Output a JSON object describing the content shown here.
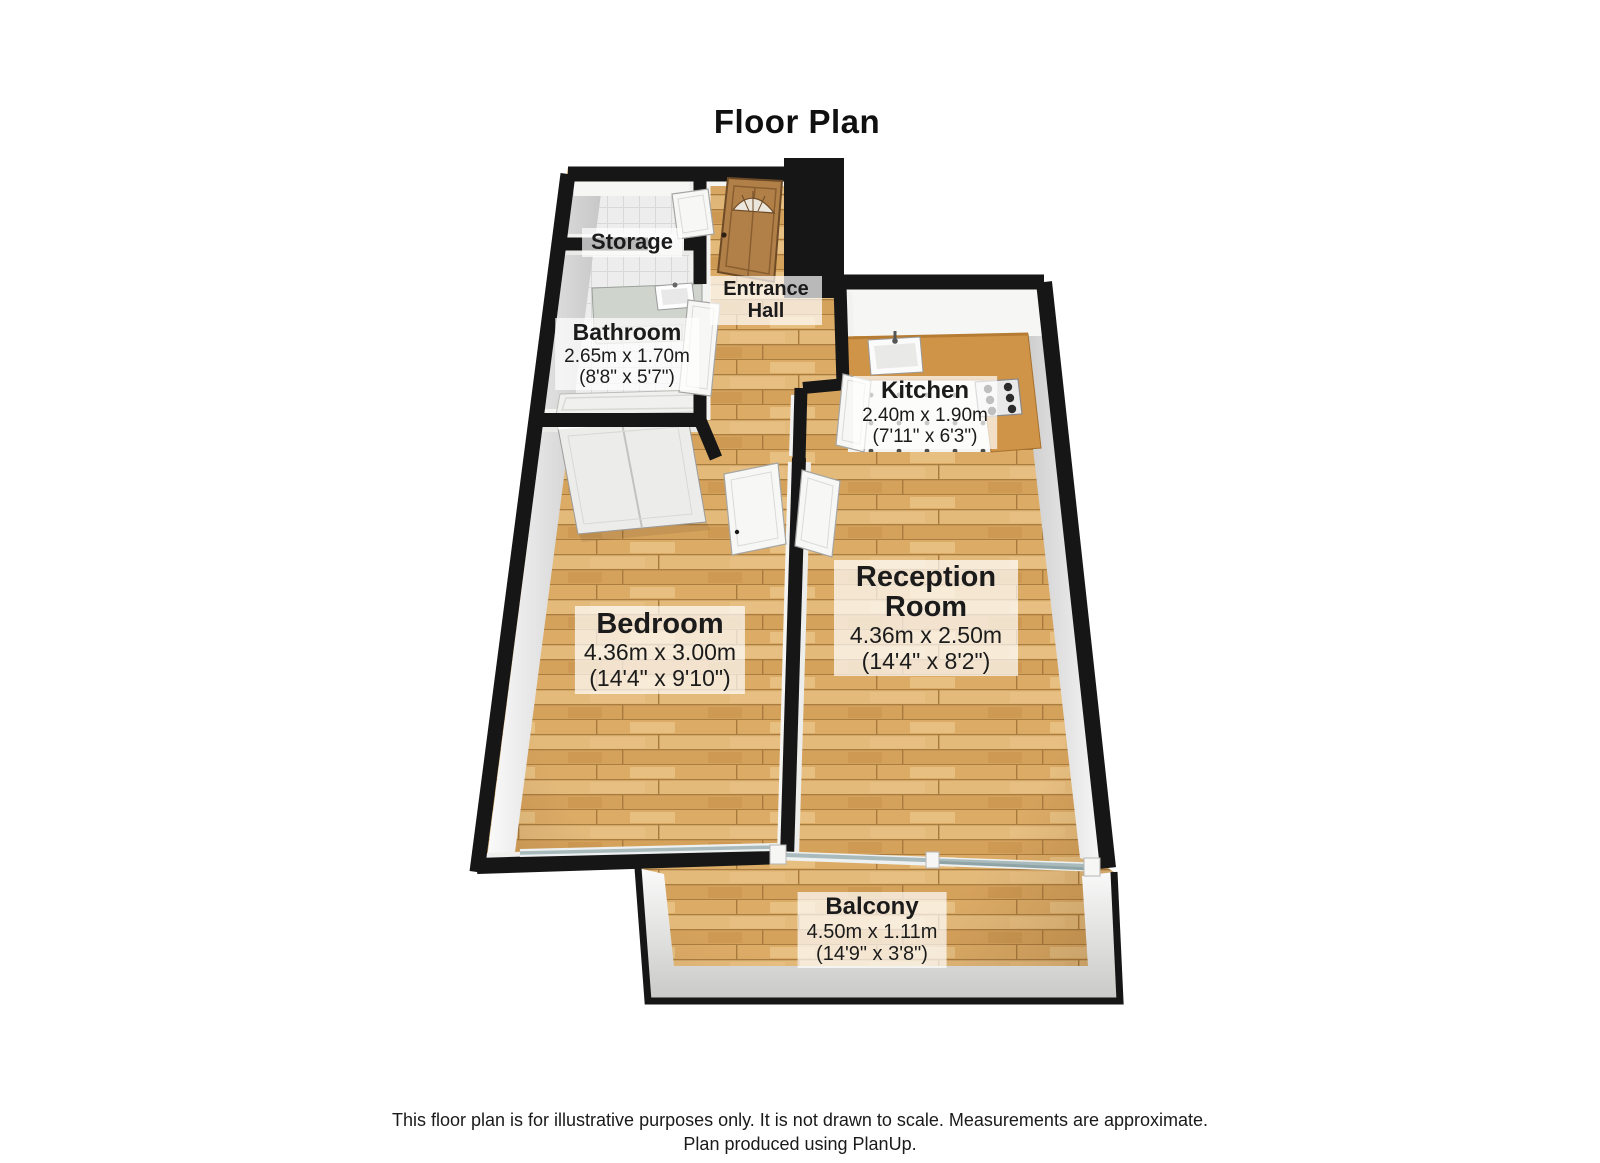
{
  "title": "Floor Plan",
  "rooms": [
    {
      "id": "storage",
      "name": "Storage"
    },
    {
      "id": "entrance-hall",
      "name": "Entrance Hall"
    },
    {
      "id": "bathroom",
      "name": "Bathroom",
      "metric": "2.65m x 1.70m",
      "imperial": "(8'8\" x 5'7\")"
    },
    {
      "id": "kitchen",
      "name": "Kitchen",
      "metric": "2.40m x 1.90m",
      "imperial": "(7'11\" x 6'3\")"
    },
    {
      "id": "bedroom",
      "name": "Bedroom",
      "metric": "4.36m x 3.00m",
      "imperial": "(14'4\" x 9'10\")"
    },
    {
      "id": "reception-room",
      "name": "Reception Room",
      "metric": "4.36m x 2.50m",
      "imperial": "(14'4\" x 8'2\")"
    },
    {
      "id": "balcony",
      "name": "Balcony",
      "metric": "4.50m x 1.11m",
      "imperial": "(14'9\" x 3'8\")"
    }
  ],
  "footer": {
    "line1": "This floor plan is for illustrative purposes only. It is not drawn to scale. Measurements are approximate.",
    "line2": "Plan produced using PlanUp."
  },
  "colors": {
    "wall": "#161616",
    "wood": "#d9a866",
    "counter": "#d09448",
    "glass": "#a9babc",
    "label_background": "rgba(255,255,255,0.70)"
  }
}
